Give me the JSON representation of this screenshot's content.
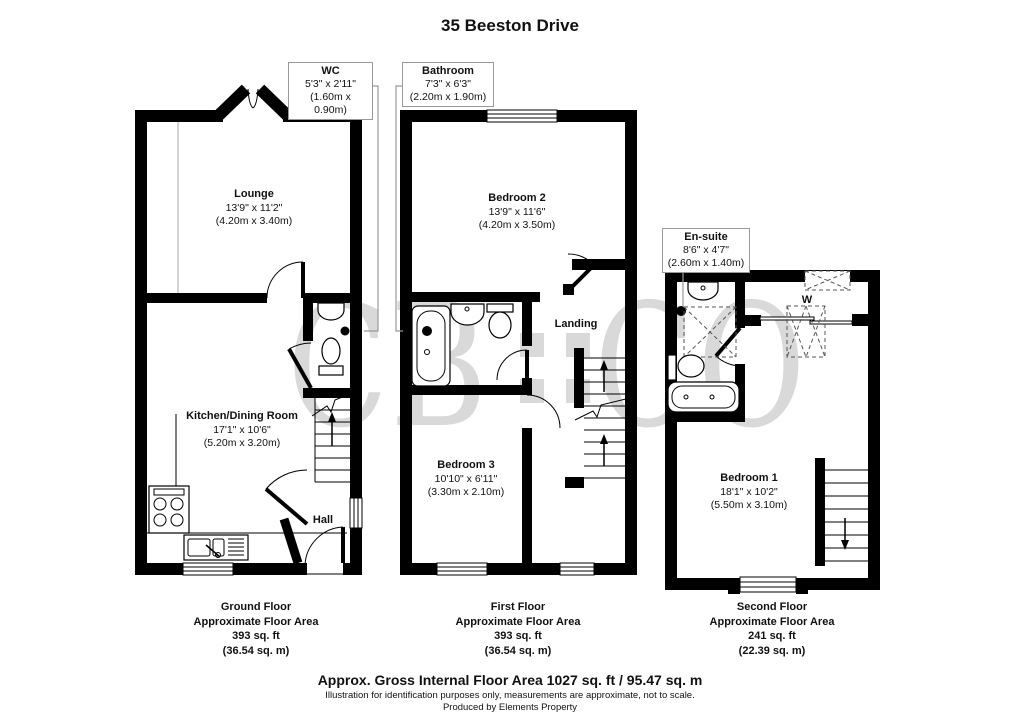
{
  "title": "35 Beeston Drive",
  "watermark": {
    "left": "CB",
    "right": "CO"
  },
  "callouts": {
    "wc": {
      "name": "WC",
      "imperial": "5'3\" x 2'11\"",
      "metric": "(1.60m x 0.90m)"
    },
    "bathroom": {
      "name": "Bathroom",
      "imperial": "7'3\" x 6'3\"",
      "metric": "(2.20m x 1.90m)"
    },
    "ensuite": {
      "name": "En-suite",
      "imperial": "8'6\" x 4'7\"",
      "metric": "(2.60m x 1.40m)"
    }
  },
  "rooms": {
    "lounge": {
      "name": "Lounge",
      "imperial": "13'9\" x 11'2\"",
      "metric": "(4.20m x 3.40m)"
    },
    "kitchen": {
      "name": "Kitchen/Dining Room",
      "imperial": "17'1\" x 10'6\"",
      "metric": "(5.20m x 3.20m)"
    },
    "hall": {
      "name": "Hall"
    },
    "bedroom2": {
      "name": "Bedroom 2",
      "imperial": "13'9\" x 11'6\"",
      "metric": "(4.20m x 3.50m)"
    },
    "landing": {
      "name": "Landing"
    },
    "bedroom3": {
      "name": "Bedroom 3",
      "imperial": "10'10\" x 6'11\"",
      "metric": "(3.30m x 2.10m)"
    },
    "bedroom1": {
      "name": "Bedroom 1",
      "imperial": "18'1\" x 10'2\"",
      "metric": "(5.50m x 3.10m)"
    },
    "wardrobe": {
      "name": "W"
    }
  },
  "floors": [
    {
      "name": "Ground Floor",
      "area_label": "Approximate Floor Area",
      "sqft": "393 sq. ft",
      "sqm": "(36.54 sq. m)"
    },
    {
      "name": "First Floor",
      "area_label": "Approximate Floor Area",
      "sqft": "393 sq. ft",
      "sqm": "(36.54 sq. m)"
    },
    {
      "name": "Second Floor",
      "area_label": "Approximate Floor Area",
      "sqft": "241 sq. ft",
      "sqm": "(22.39 sq. m)"
    }
  ],
  "footer": {
    "gross": "Approx. Gross Internal Floor Area 1027 sq. ft / 95.47 sq. m",
    "disclaimer": "Illustration for identification purposes only, measurements are approximate, not to scale.",
    "producer": "Produced by Elements Property"
  }
}
